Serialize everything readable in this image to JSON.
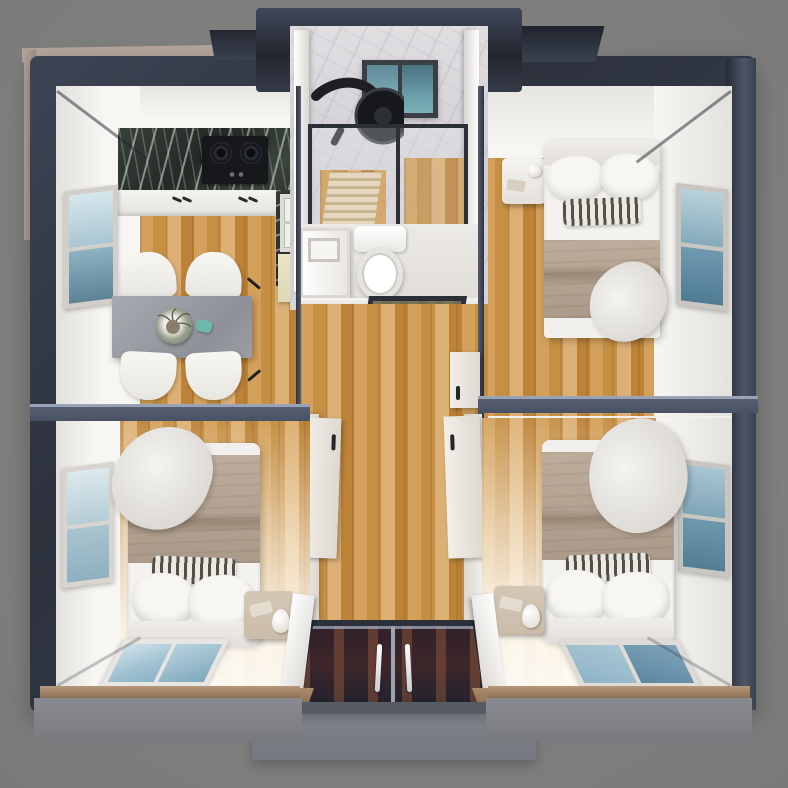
{
  "scene": {
    "label": "Top-down 3D render of an expandable container home floor plan",
    "style": "photorealistic render, no visible text",
    "structure_color_hint": "dark slate steel frame with white interior walls"
  },
  "palette": {
    "bg": "#7c7c7a",
    "frameDark": "#2c313c",
    "frameMid": "#414a5c",
    "frameLight": "#8b94a9",
    "beigeEdge": "#b3a39b",
    "wallWhite": "#f2f0ed",
    "woodFloor": "#cf9c57",
    "woodFloorDark": "#b17f3b",
    "marbleCounterDark": "#2f3631",
    "marbleBathLight": "#d8d6d9",
    "glassBlue": "#6d97ac",
    "glassDark": "#4a7389",
    "glassPale": "#b7cfda",
    "tableGray": "#9da0a7",
    "blanketTan": "#b4a392",
    "stripeDark": "#514f48",
    "entryDoorGlass": "#35222b",
    "stepGray": "#797c83",
    "creamCabinet": "#e9e4c8",
    "nightstandTan": "#cbbca9",
    "cooktopBlack": "#17181c"
  },
  "rooms": {
    "kitchen": {
      "label": "Kitchen and dining area (top left)",
      "furniture": [
        "dark-marble-countertop",
        "gas-cooktop-2-burner",
        "white-base-cabinets",
        "kitchen-sink",
        "cream-cabinet",
        "gray-dining-table",
        "white-dining-chair x4",
        "plant-centerpiece",
        "teal-cup",
        "side-wall-window",
        "wood-floor"
      ]
    },
    "bathroom": {
      "label": "Bathroom module (top center, protruding)",
      "furniture": [
        "marble-walls",
        "small-window",
        "black-round-rain-shower-head",
        "glass-shower-enclosure",
        "wood-slat-shower-mat",
        "toilet",
        "white-vanity-sink",
        "glass-bathroom-door"
      ]
    },
    "bedroom_top_right": {
      "label": "Bedroom (top right)",
      "furniture": [
        "double-bed",
        "white-pillows x2",
        "striped-accent-pillow",
        "tan-blanket",
        "white-throw",
        "nightstand-with-accessories",
        "side-wall-window",
        "wood-floor"
      ]
    },
    "bedroom_bottom_left": {
      "label": "Bedroom (bottom left)",
      "furniture": [
        "double-bed",
        "white-pillows x2",
        "striped-accent-pillow",
        "tan-blanket",
        "white-throw",
        "nightstand-with-lamp",
        "side-wall-window",
        "bottom-wall-window",
        "sunlit-wood-floor"
      ]
    },
    "bedroom_bottom_right": {
      "label": "Bedroom (bottom right)",
      "furniture": [
        "double-bed",
        "white-pillows x2",
        "striped-accent-pillow",
        "tan-blanket",
        "white-throw",
        "nightstand-with-lamp",
        "side-wall-window",
        "bottom-wall-window",
        "sunlit-wood-floor"
      ]
    },
    "hallway": {
      "label": "Central hallway",
      "furniture": [
        "wood-floor",
        "interior-door-left",
        "interior-door-right x2",
        "dark-door-handles"
      ]
    },
    "entrance": {
      "label": "Entrance (bottom center)",
      "furniture": [
        "double-glass-entry-door",
        "white-vertical-handles x2",
        "white-open-side-panels x2",
        "concrete-step"
      ]
    }
  },
  "counts": {
    "bedrooms": 3,
    "bathrooms": 1,
    "beds": 3,
    "windows": 7,
    "dining_chairs": 4
  }
}
